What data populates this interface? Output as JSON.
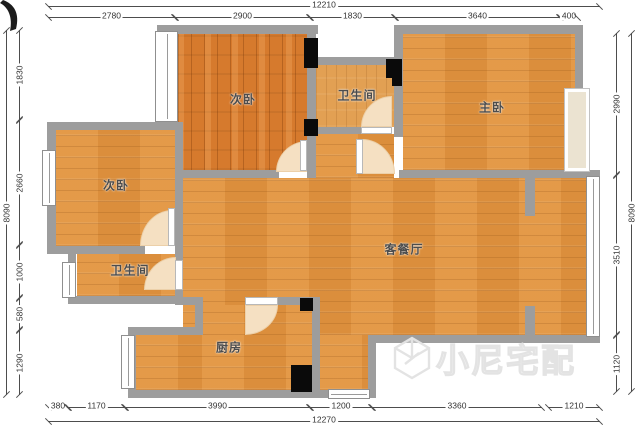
{
  "rooms": {
    "bedroom2_top": "次卧",
    "bath_top": "卫生间",
    "master": "主卧",
    "bedroom2_left": "次卧",
    "bath_left": "卫生间",
    "living": "客餐厅",
    "kitchen": "厨房"
  },
  "dims": {
    "top_total": "12210",
    "top": [
      "2780",
      "2900",
      "1830",
      "3640",
      "400"
    ],
    "left": [
      "1830",
      "2660",
      "1000",
      "580",
      "1290"
    ],
    "left_total": "8090",
    "right": [
      "2990",
      "3510",
      "1120"
    ],
    "right_total": "8090",
    "bottom": [
      "380",
      "1170",
      "3990",
      "1200",
      "3360",
      "1210"
    ],
    "bottom_total": "12270"
  },
  "watermark": {
    "text": "小尼宅配"
  },
  "colors": {
    "wall": "#9d9d9d",
    "floor_light": "#e2943f",
    "floor_dark": "#d67a2d",
    "door_arc": "#f5e0c2",
    "shaft": "#0a0a0a"
  }
}
